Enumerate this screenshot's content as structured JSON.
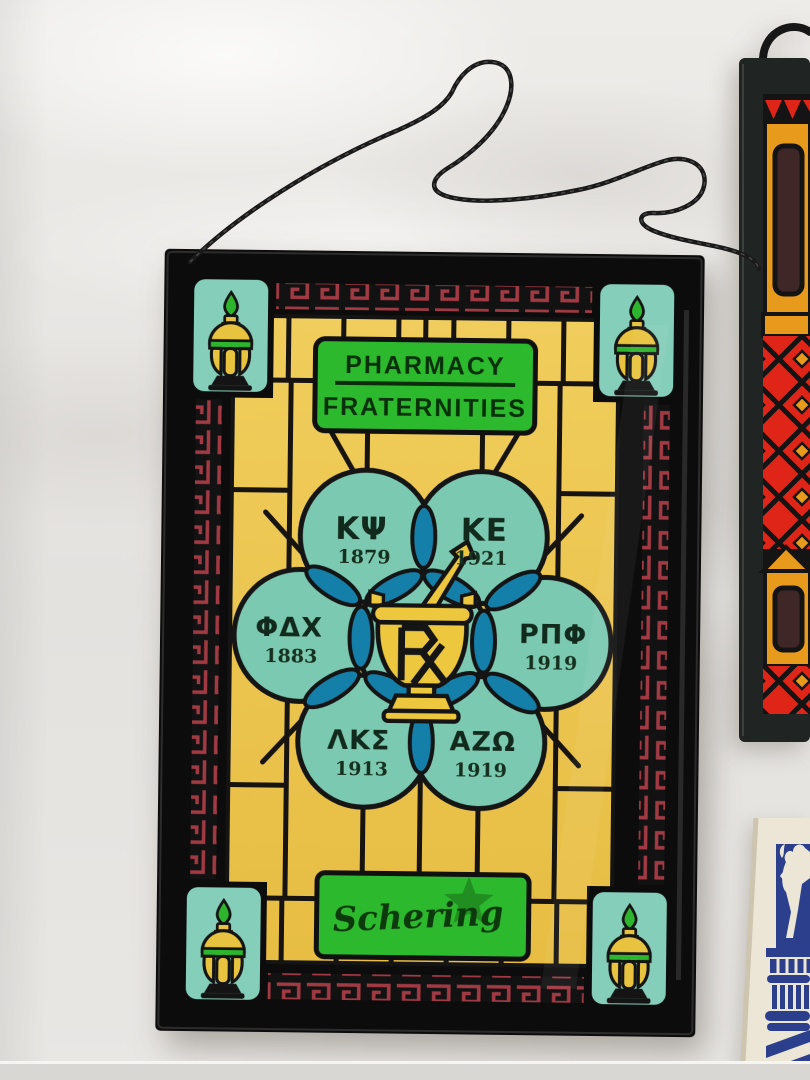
{
  "scene": {
    "setting": "vintage pharmacy stained-glass plaques laid on white cloth",
    "cloth_color": "#e8e6e3",
    "hanging_cord": "black twisted cord"
  },
  "main_plaque": {
    "name": "pharmacy-fraternities-stained-glass-plaque",
    "header": {
      "line1": "PHARMACY",
      "line2": "FRATERNITIES"
    },
    "brand_signature": "Schering",
    "center_icon": "mortar-pestle-rx",
    "corner_icon": "apothecary-show-globe",
    "border_pattern": "greek-key-meander",
    "fraternities": [
      {
        "letters": "ΚΨ",
        "year": "1879"
      },
      {
        "letters": "ΚΕ",
        "year": "1921"
      },
      {
        "letters": "ΦΔΧ",
        "year": "1883"
      },
      {
        "letters": "ΡΠΦ",
        "year": "1919"
      },
      {
        "letters": "ΛΚΣ",
        "year": "1913"
      },
      {
        "letters": "ΑΖΩ",
        "year": "1919"
      }
    ],
    "colors": {
      "frame_black": "#0c0c0c",
      "glass_yellow": "#ecc54e",
      "circle_teal": "#7cc9b1",
      "overlap_blue": "#1480a9",
      "accent_green": "#2db92d",
      "meander_red": "#a23a44",
      "corner_patch_teal": "#85ceb9",
      "lettering_dark": "#122a1d"
    }
  },
  "right_plaque": {
    "name": "partial-red-orange-geometric-stained-glass-panel",
    "colors": {
      "red": "#df2418",
      "orange": "#e89a1c",
      "window_brown": "#3f2727",
      "frame": "#202423"
    }
  },
  "bottom_right_card": {
    "name": "partial-blue-on-cream-card-rearing-horse-on-column",
    "colors": {
      "ink_blue": "#2c3f8d",
      "card_cream": "#ece6d7"
    }
  }
}
